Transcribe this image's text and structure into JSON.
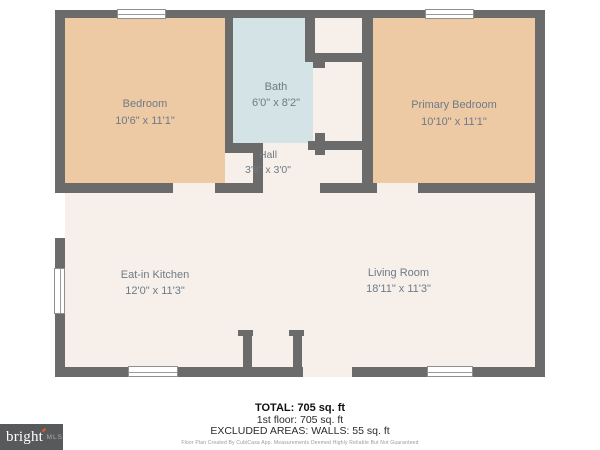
{
  "floor_plan": {
    "rooms": [
      {
        "name": "Bedroom",
        "dimensions": "10'6\" x 11'1\""
      },
      {
        "name": "Bath",
        "dimensions": "6'0\" x 8'2\""
      },
      {
        "name": "Primary Bedroom",
        "dimensions": "10'10\" x 11'1\""
      },
      {
        "name": "Hall",
        "dimensions": "3'8\" x 3'0\""
      },
      {
        "name": "Eat-in Kitchen",
        "dimensions": "12'0\" x 11'3\""
      },
      {
        "name": "Living Room",
        "dimensions": "18'11\" x 11'3\""
      }
    ],
    "colors": {
      "wall": "#6b6b6b",
      "bedroom_fill": "#edc9a4",
      "bath_fill": "#d4e3e5",
      "floor_fill": "#f7efe9",
      "label_text": "#6e7b88",
      "logo_background": "#58595b",
      "logo_accent": "#f05a28"
    }
  },
  "summary": {
    "total": "TOTAL: 705 sq. ft",
    "first_floor": "1st floor: 705 sq. ft",
    "excluded": "EXCLUDED AREAS: WALLS: 55 sq. ft",
    "disclaimer": "Floor Plan Created By CubiCasa App. Measurements Deemed Highly Reliable But Not Guaranteed"
  },
  "logo": {
    "brand": "bright",
    "suffix": "MLS"
  }
}
